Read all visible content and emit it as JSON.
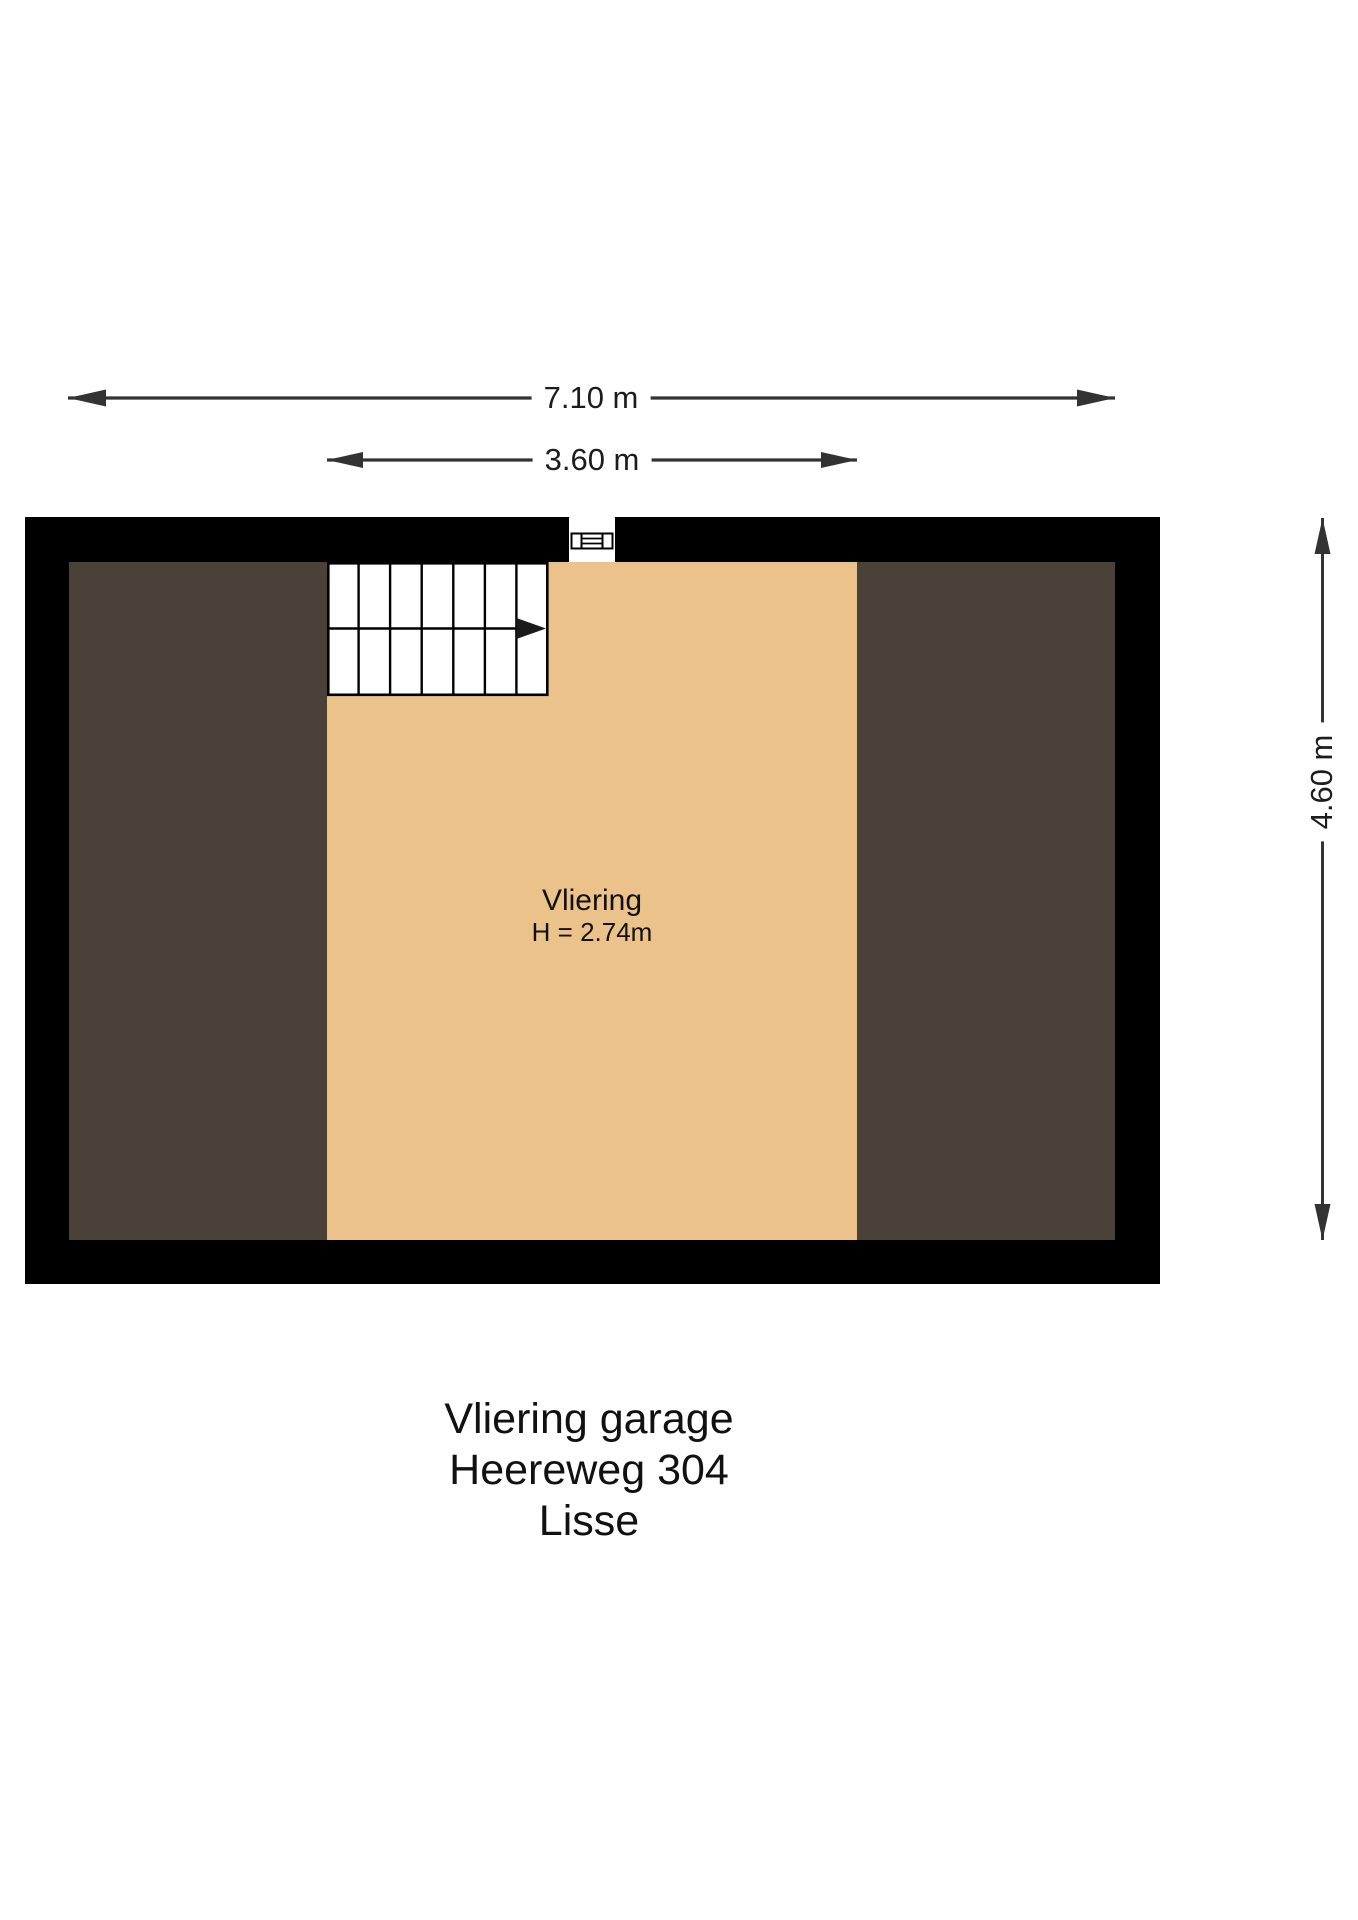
{
  "plan": {
    "room": {
      "name": "Vliering",
      "height_note": "H = 2.74m"
    }
  },
  "dimensions": {
    "total_width": "7.10 m",
    "vliering_width": "3.60 m",
    "total_depth": "4.60 m"
  },
  "caption": {
    "line1": "Vliering garage",
    "line2": "Heereweg 304",
    "line3": "Lisse"
  },
  "colors": {
    "wall": "#000000",
    "floor": "#ebc38a",
    "under_roof": "#4a4238",
    "ink": "#333333"
  }
}
